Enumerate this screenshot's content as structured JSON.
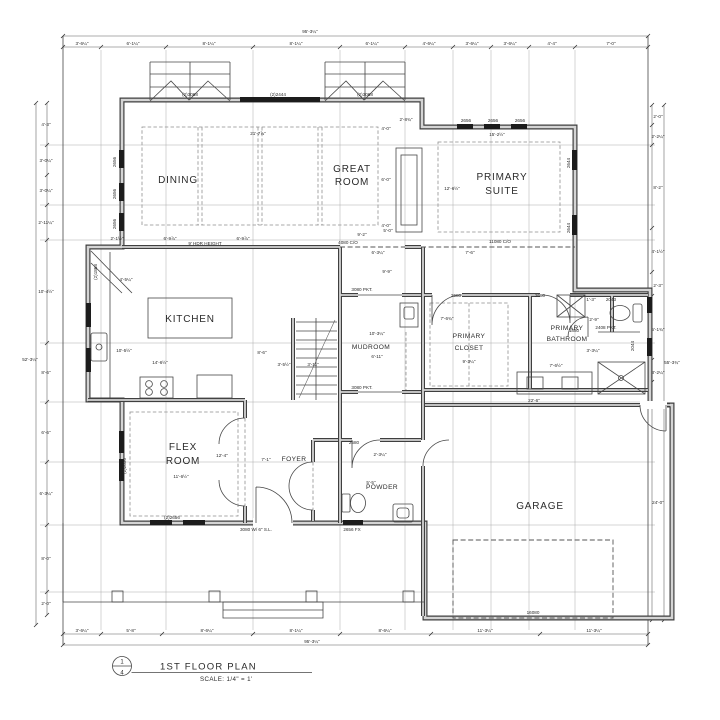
{
  "title_block": {
    "detail_number": "1",
    "sheet_number": "4",
    "title": "1ST FLOOR PLAN",
    "scale_label": "SCALE:  1/4\" = 1'"
  },
  "rooms": {
    "dining": "DINING",
    "great_1": "GREAT",
    "great_2": "ROOM",
    "suite_1": "PRIMARY",
    "suite_2": "SUITE",
    "kitchen": "KITCHEN",
    "mudroom": "MUDROOM",
    "closet_1": "PRIMARY",
    "closet_2": "CLOSET",
    "bath_1": "PRIMARY",
    "bath_2": "BATHROOM",
    "flex_1": "FLEX",
    "flex_2": "ROOM",
    "foyer": "FOYER",
    "powder": "POWDER",
    "garage": "GARAGE"
  },
  "dims": {
    "top": {
      "overall": "95'-3¼\"",
      "segments": [
        "3'-6¼\"",
        "6'-1¼\"",
        "8'-1¼\"",
        "8'-1¼\"",
        "6'-1¼\"",
        "4'-6¼\"",
        "3'-6¼\"",
        "3'-6¼\"",
        "4'-4\"",
        "7'-0\""
      ]
    },
    "bottom": {
      "overall": "95'-3¼\"",
      "segments": [
        "3'-6¼\"",
        "5'-8\"",
        "8'-6¼\"",
        "8'-1¼\"",
        "8'-6¼\"",
        "11'-3¼\"",
        "11'-3¼\""
      ]
    },
    "left": {
      "overall": "52'-3¼\"",
      "segments": [
        "4'-3\"",
        "3'-0¼\"",
        "3'-0¼\"",
        "2'-11¼\"",
        "10'-4½\"",
        "8'-6\"",
        "6'-6\"",
        "6'-3¼\"",
        "8'-0\"",
        "2'-0\""
      ]
    },
    "right": {
      "overall": "55'-3¾\"",
      "segments": [
        "2'-0\"",
        "2'-2¼\"",
        "8'-2\"",
        "4'-1½\"",
        "2'-3\"",
        "5'-1¾\"",
        "3'-2¼\"",
        "24'-0\""
      ]
    }
  },
  "ann": {
    "bay_left": "(2)3068",
    "header_center": "(2)2444",
    "bay_right": "(2)3068",
    "great_width": "21'-7⅞\"",
    "hdr_height": "9' HDR HEIGHT",
    "d_2_1h": "2'-1½\"",
    "d_6_9a": "6'-9⅞\"",
    "d_6_9b": "6'-9⅞\"",
    "d_9_2": "9'-2\"",
    "co_4080": "4080 C/O",
    "d_5_0": "5'-0\"",
    "co_11080": "11080 C/O",
    "dining_win_1": "2656",
    "dining_win_2": "2656",
    "dining_win_3": "2656",
    "suite_win_1": "2656",
    "suite_win_2": "2656",
    "suite_win_3": "2656",
    "suite_win_r1": "2644",
    "suite_win_r2": "2644",
    "suite_w": "15'-2½\"",
    "suite_h": "12'-6½\"",
    "fp_d1": "4'-0\"",
    "fp_d2": "6'-0\"",
    "fp_d3": "4'-0\"",
    "fp_d4": "2'-8¾\"",
    "pantry_door": "(2)1868",
    "k_pantry_d": "4'-5¼\"",
    "k_w": "14'-6½\"",
    "k_h": "10'-5½\"",
    "d_8_6": "8'-6\"",
    "d_3_5": "3'-5½\"",
    "d_3_11": "3'-11\"",
    "pkt_top": "3080 PKT.",
    "pkt_bottom": "3080 PKT.",
    "mud_h": "9'-9\"",
    "mud_w": "6'-11\"",
    "mud_d": "10'-3¼\"",
    "closet_door": "2680",
    "bath_door": "2680",
    "closet_w": "9'-3¼\"",
    "closet_d": "7'-6¾\"",
    "hall_w": "7'-6\"",
    "d_6_3": "6'-3¼\"",
    "bath_w": "7'-6½\"",
    "bath_d": "3'-3¼\"",
    "wc_door": "1880",
    "wc_d": "2'-9\"",
    "wc_clr": "1'-3\"",
    "wc_win": "2043",
    "pkt_wc": "2408 PKT.",
    "shower_win": "2044",
    "flex_win_side": "(2)2656",
    "flex_win_front": "(2)2656",
    "flex_w": "11'-6½\"",
    "flex_h": "12'-4\"",
    "foyer_w": "7'-1\"",
    "front_door": "3080 W/ 6\" S.L.",
    "powder_door": "2680",
    "powder_w": "2'-3¼\"",
    "powder_d": "5'-5\"",
    "fixed_win": "2656 FX",
    "garage_w": "22'-6\"",
    "garage_door": "16080"
  }
}
